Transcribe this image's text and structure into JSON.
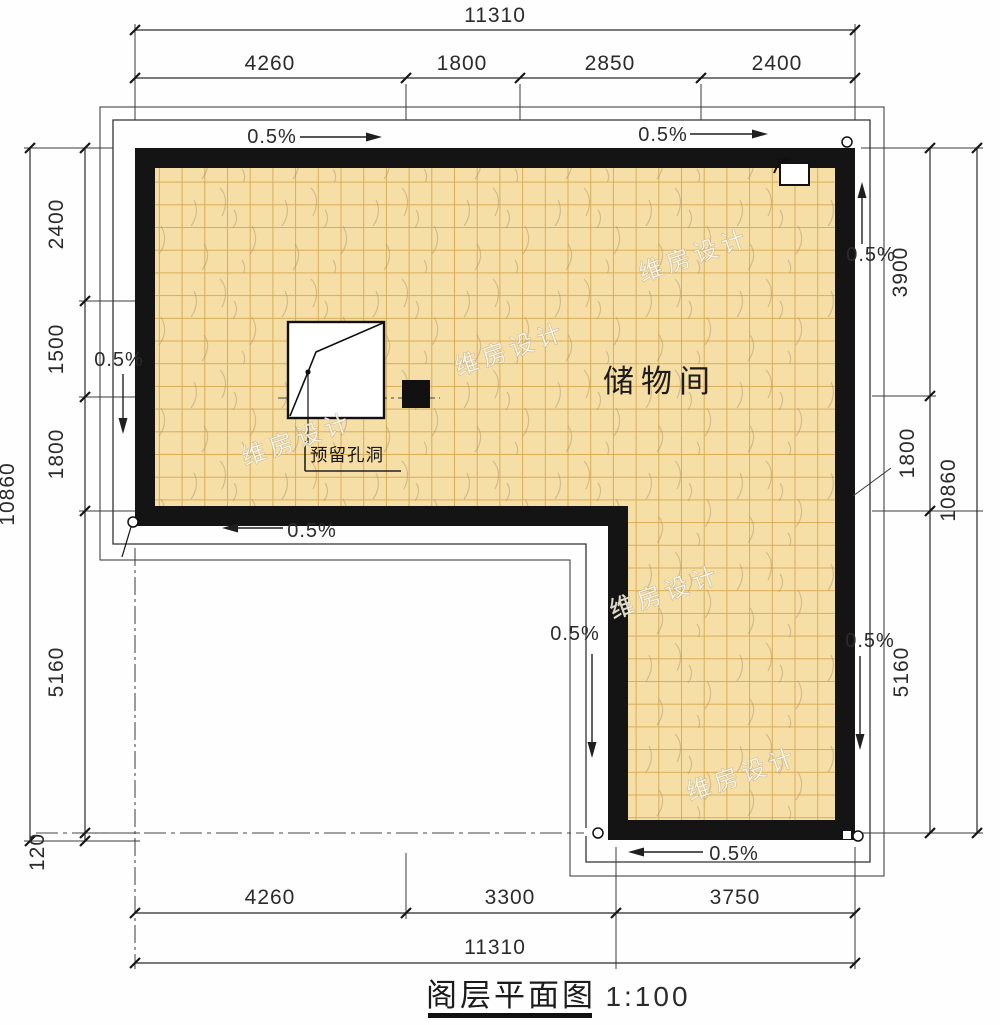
{
  "title": {
    "text": "阁层平面图",
    "scale": "1:100"
  },
  "room": {
    "label": "储物间"
  },
  "hole": {
    "label": "预留孔洞"
  },
  "slope": {
    "label": "0.5%"
  },
  "watermark": {
    "text": "维房设计"
  },
  "dimensions": {
    "top": {
      "overall": "11310",
      "segments": [
        "4260",
        "1800",
        "2850",
        "2400"
      ]
    },
    "bottom": {
      "overall": "11310",
      "segments": [
        "4260",
        "3300",
        "3750"
      ]
    },
    "left": {
      "overall": "10860",
      "segments": [
        "2400",
        "1500",
        "1800",
        "5160",
        "120"
      ]
    },
    "right": {
      "overall": "10860",
      "segments": [
        "3900",
        "1800",
        "5160"
      ]
    }
  },
  "colors": {
    "floor": "#f6dfa6",
    "grid_line": "#d9ad56",
    "wall": "#141414",
    "line": "#2a2a2a"
  }
}
